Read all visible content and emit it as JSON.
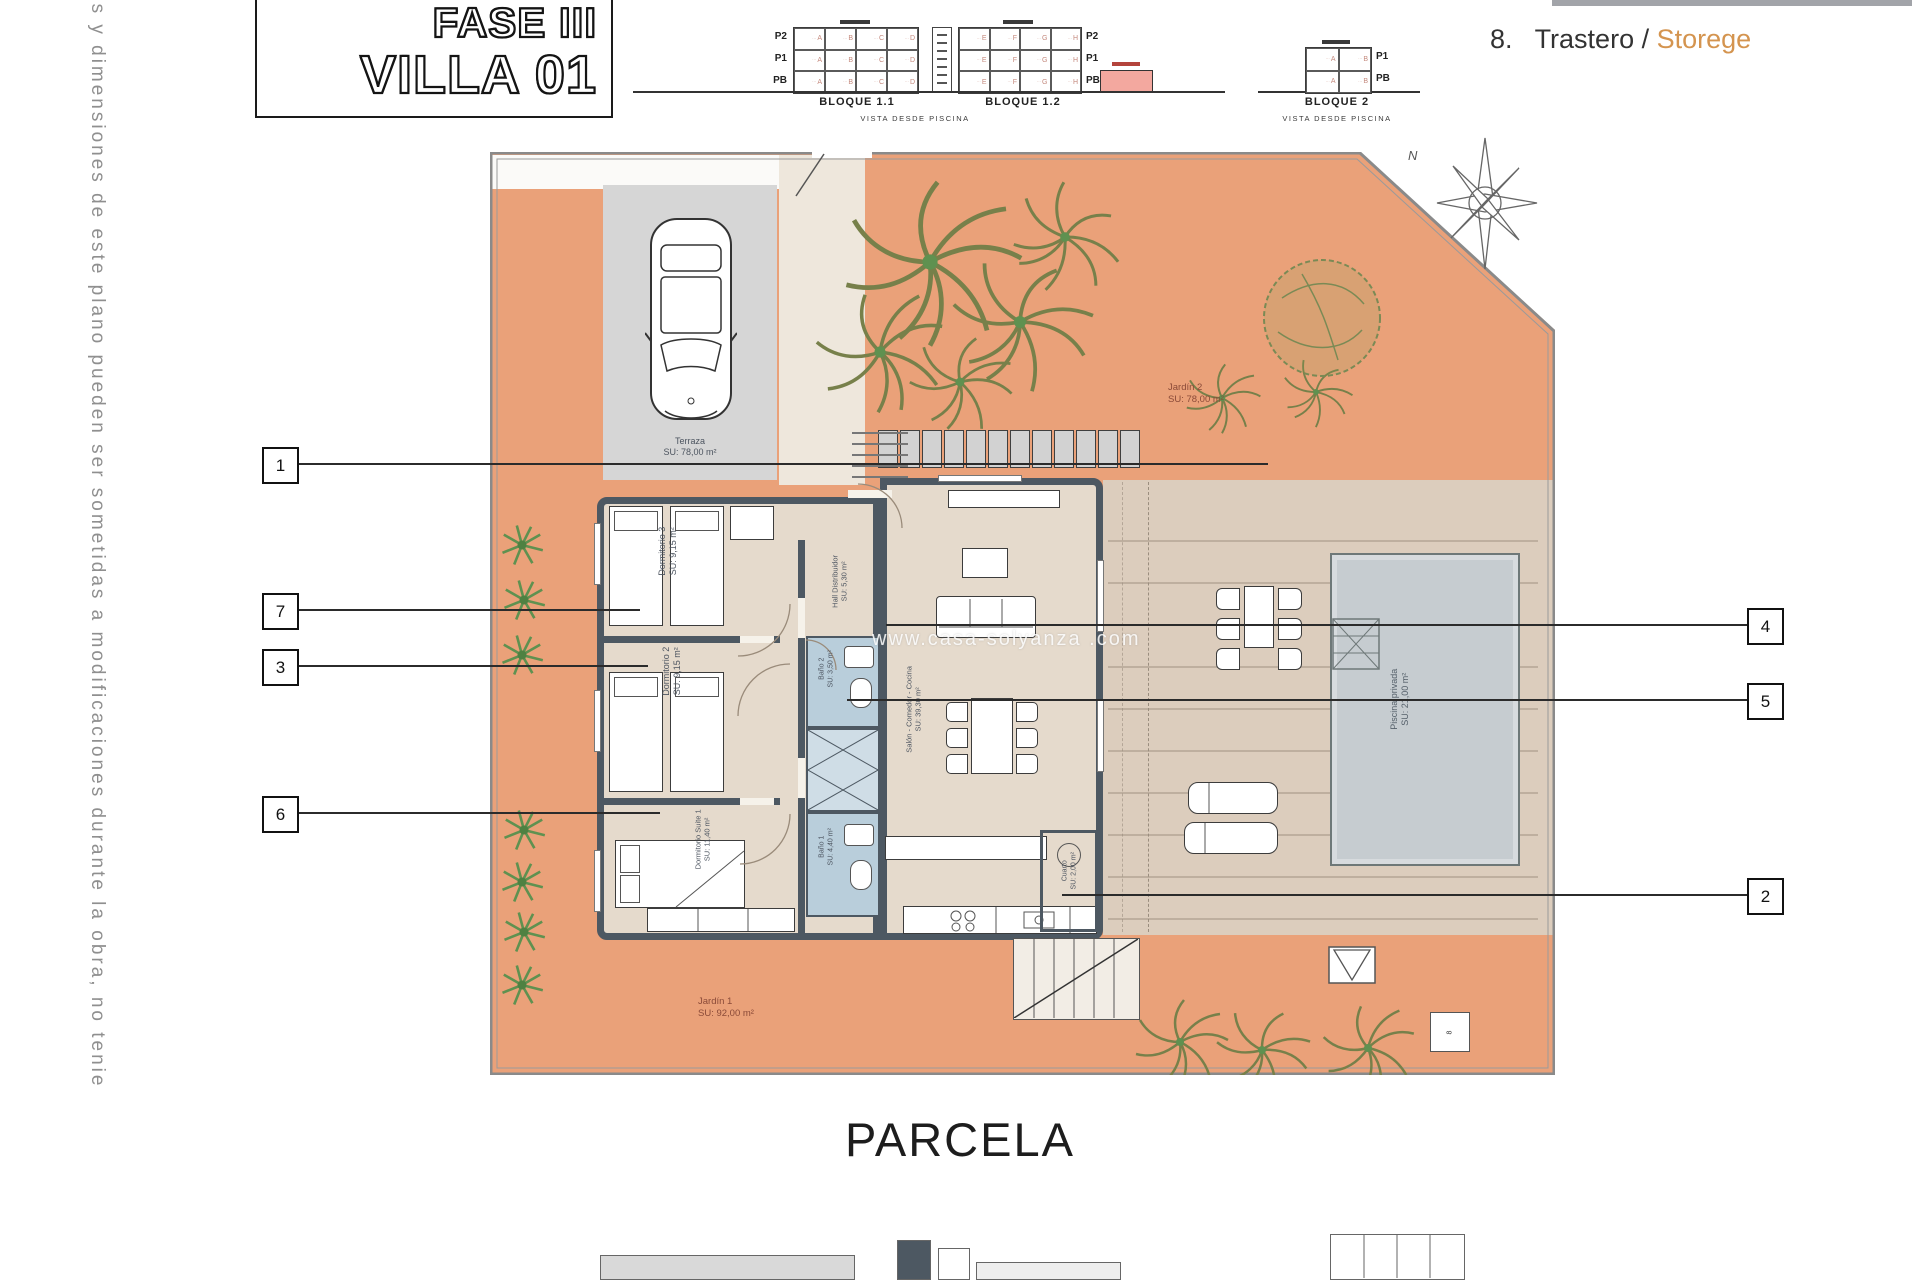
{
  "side_note": "es y dimensiones de este plano pueden ser sometidas a modificaciones durante la obra, no tenie",
  "title_block": {
    "line1": "FASE III",
    "line2": "VILLA 01"
  },
  "legend": {
    "number": "8.",
    "name_es": "Trastero",
    "separator": " / ",
    "name_en": "Storege"
  },
  "diagrams": {
    "levels3": [
      "P2",
      "P1",
      "PB"
    ],
    "levels2": [
      "P1",
      "PB"
    ],
    "bloque11": {
      "name": "BLOQUE 1.1",
      "columns": [
        "A",
        "B",
        "C",
        "D"
      ],
      "rows": 3,
      "caption": "VISTA DESDE PISCINA"
    },
    "bloque12": {
      "name": "BLOQUE 1.2",
      "columns": [
        "E",
        "F",
        "G",
        "H"
      ],
      "rows": 3
    },
    "bloque2": {
      "name": "BLOQUE 2",
      "columns": [
        "A",
        "B"
      ],
      "rows": 2,
      "caption": "VISTA DESDE PISCINA"
    }
  },
  "plan": {
    "compass": "N",
    "watermark": "www.casa-solyanza .com",
    "parcela": "PARCELA",
    "rooms": {
      "terraza": {
        "name": "Terraza",
        "area": "SU: 78,00 m²"
      },
      "dormitorio3": {
        "name": "Dormitorio 3",
        "area": "SU: 9,15 m²"
      },
      "dormitorio2": {
        "name": "Dormitorio 2",
        "area": "SU: 9,15 m²"
      },
      "suite1": {
        "name": "Dormitorio Suite 1",
        "area": "SU: 11,40 m²"
      },
      "hall": {
        "name": "Hall Distribuidor",
        "area": "SU: 5,30 m²"
      },
      "bano2": {
        "name": "Baño 2",
        "area": "SU: 3,50 m²"
      },
      "bano1": {
        "name": "Baño 1",
        "area": "SU: 4,40 m²"
      },
      "salon": {
        "name": "Salón - Comedor - Cocina",
        "area": "SU: 39,30 m²"
      },
      "cuarto": {
        "name": "Cuarto",
        "area": "SU: 2,00 m²"
      },
      "piscina": {
        "name": "Piscina privada",
        "area": "SU: 21,00 m²"
      },
      "jardin1": {
        "name": "Jardín 1",
        "area": "SU: 92,00 m²"
      },
      "jardin2": {
        "name": "Jardín 2",
        "area": "SU: 78,00 m²"
      }
    },
    "storage_marker": "8",
    "callouts_left": [
      "1",
      "7",
      "3",
      "6"
    ],
    "callouts_right": [
      "4",
      "5",
      "2"
    ]
  },
  "colors": {
    "garden": "#eaa179",
    "pool": "#c6ccd0",
    "bath": "#b9cedb",
    "highlight_pink": "#f3a89f",
    "storege_accent": "#d4944f",
    "walls": "#4d5862"
  }
}
